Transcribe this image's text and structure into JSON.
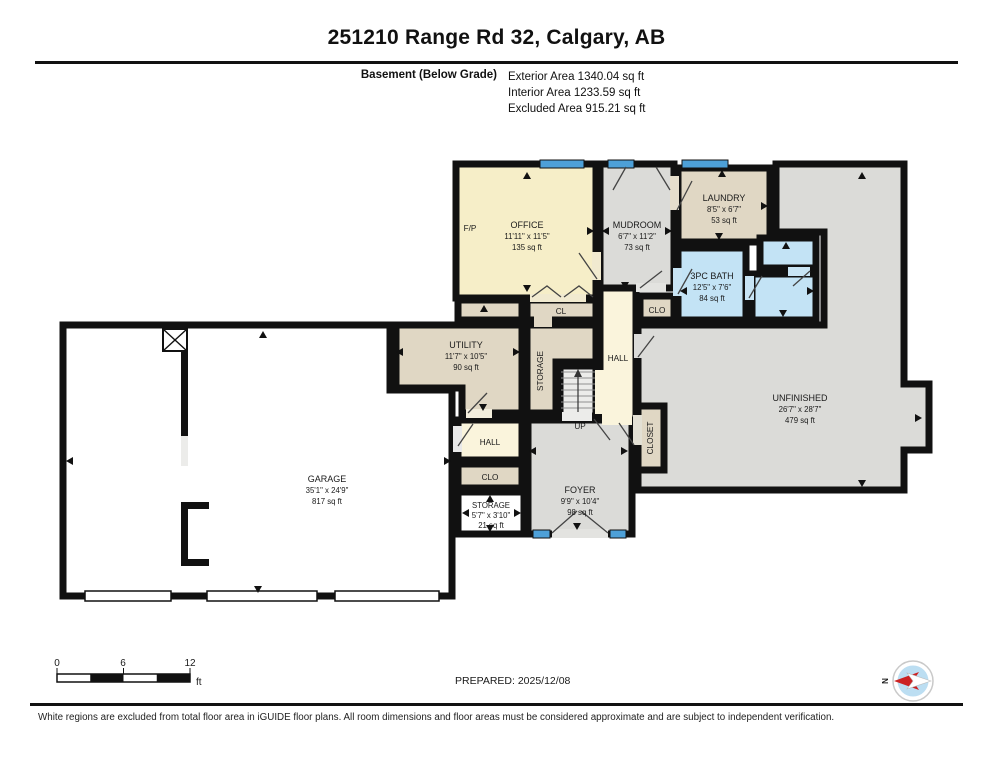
{
  "header": {
    "title": "251210 Range Rd 32, Calgary, AB",
    "floor_label": "Basement (Below Grade)",
    "exterior_area": "Exterior Area 1340.04 sq ft",
    "interior_area": "Interior Area 1233.59 sq ft",
    "excluded_area": "Excluded Area 915.21 sq ft"
  },
  "rooms": {
    "office": {
      "name": "OFFICE",
      "dims": "11'11\" x 11'5\"",
      "area": "135 sq ft"
    },
    "mudroom": {
      "name": "MUDROOM",
      "dims": "6'7\" x 11'2\"",
      "area": "73 sq ft"
    },
    "laundry": {
      "name": "LAUNDRY",
      "dims": "8'5\" x 6'7\"",
      "area": "53 sq ft"
    },
    "bath": {
      "name": "3PC BATH",
      "dims": "12'5\" x 7'6\"",
      "area": "84 sq ft"
    },
    "unfinished": {
      "name": "UNFINISHED",
      "dims": "26'7\" x 28'7\"",
      "area": "479 sq ft"
    },
    "utility": {
      "name": "UTILITY",
      "dims": "11'7\" x 10'5\"",
      "area": "90 sq ft"
    },
    "garage": {
      "name": "GARAGE",
      "dims": "35'1\" x 24'9\"",
      "area": "817 sq ft"
    },
    "foyer": {
      "name": "FOYER",
      "dims": "9'9\" x 10'4\"",
      "area": "98 sq ft"
    },
    "storage_small": {
      "name": "STORAGE",
      "dims": "5'7\" x 3'10\"",
      "area": "21 sq ft"
    }
  },
  "labels": {
    "hall_upper": "HALL",
    "hall_lower": "HALL",
    "cl": "CL",
    "clo_bath": "CLO",
    "clo_lower": "CLO",
    "storage_column": "STORAGE",
    "closet": "CLOSET",
    "up": "UP",
    "fireplace": "F/P"
  },
  "legend": {
    "tick0": "0",
    "tick6": "6",
    "tick12": "12",
    "unit": "ft",
    "prepared": "PREPARED: 2025/12/08",
    "compass_north": "N"
  },
  "footer": {
    "disclaimer": "White regions are excluded from total floor area in iGUIDE floor plans. All room dimensions and floor areas must be considered approximate and are subject to independent verification."
  },
  "colors": {
    "finished_cream": "#F6EEC8",
    "hall_cream": "#FAF4DC",
    "storage_tan": "#E0D7C4",
    "unfinished_gray": "#DBDBD8",
    "bath_blue": "#C3E3F5",
    "window_blue": "#4DA0D8",
    "wall_black": "#111111"
  }
}
